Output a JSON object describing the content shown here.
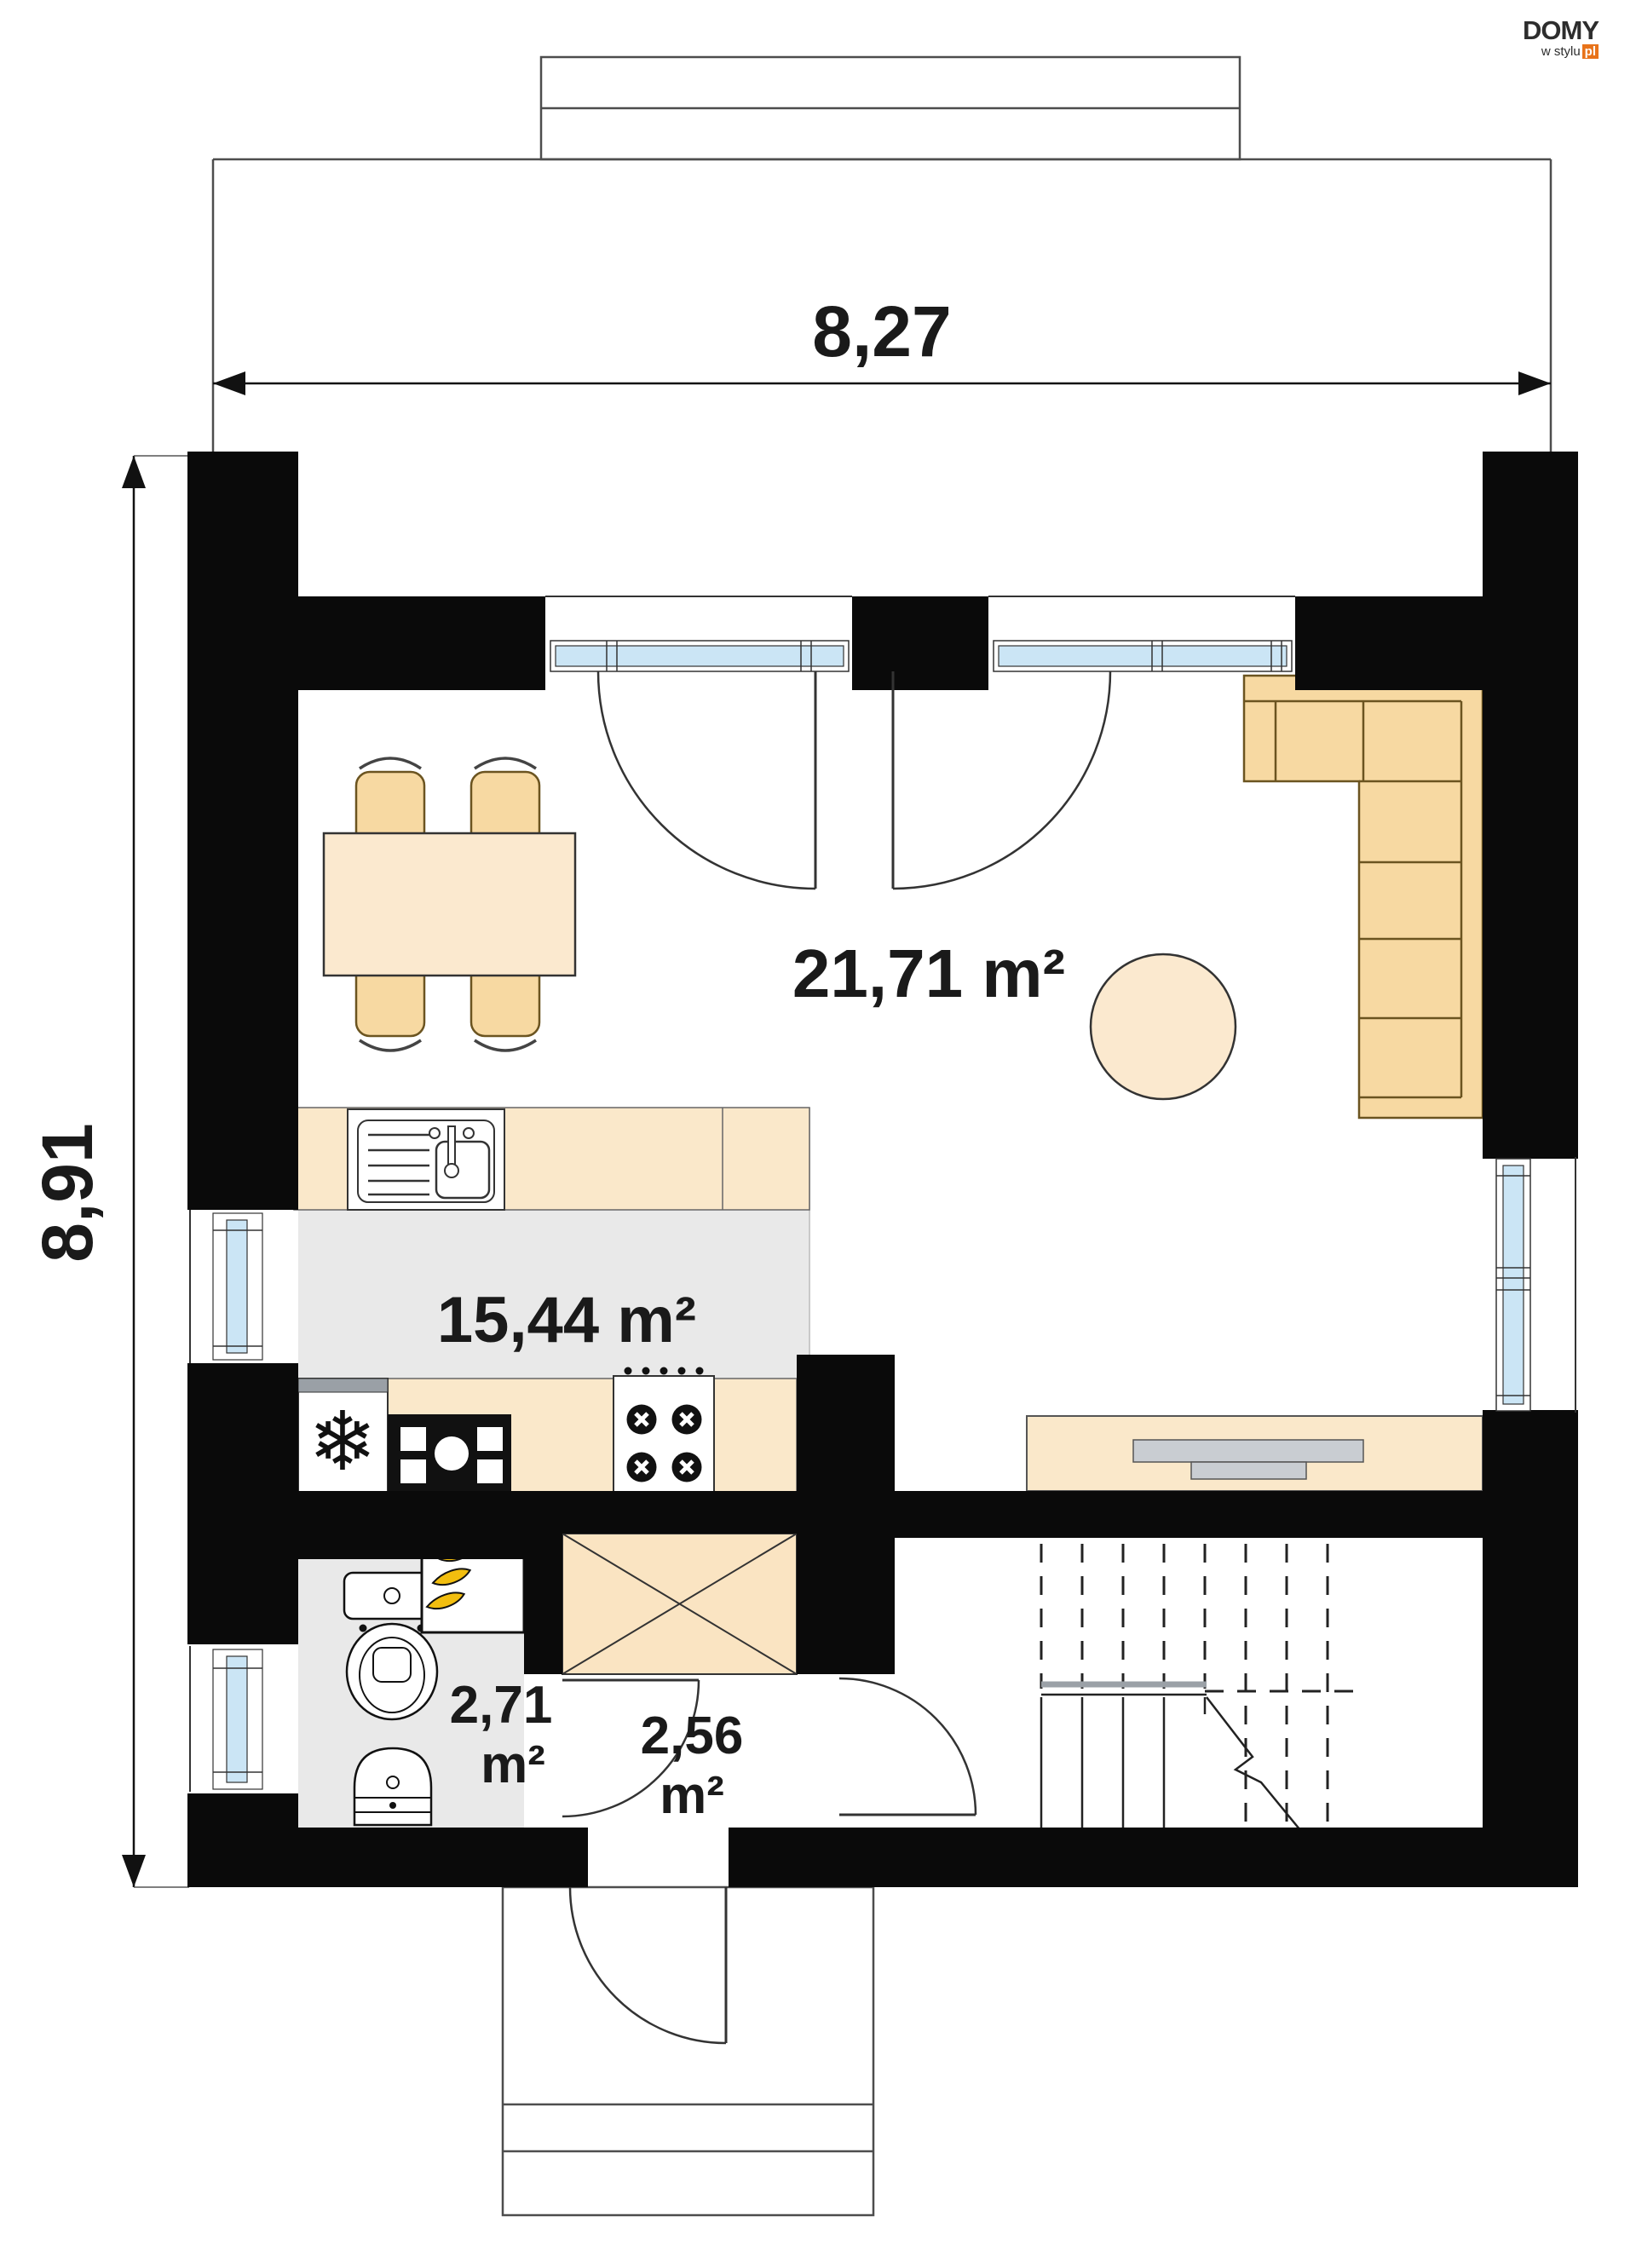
{
  "logo": {
    "brand": "DOMY",
    "tagline": "w stylu",
    "tld": "pl"
  },
  "dimensions": {
    "width": "8,27",
    "height": "8,91"
  },
  "rooms": {
    "living": {
      "area": "21,71 m²"
    },
    "kitchen": {
      "area": "15,44 m²"
    },
    "bathroom": {
      "area_value": "2,71",
      "area_unit": "m²"
    },
    "hall": {
      "area_value": "2,56",
      "area_unit": "m²"
    }
  },
  "colors": {
    "wall": "#0a0a0a",
    "floor": "#e9e9e9",
    "furn": "#f7d9a2",
    "furnLight": "#fbe9cf",
    "counter": "#fae8ca",
    "glass": "#cbe5f5",
    "accent": "#e8731a",
    "line": "#333333",
    "flame": "#f2be0f",
    "shelf": "#c9cdd2",
    "text": "#1a1a1a"
  }
}
